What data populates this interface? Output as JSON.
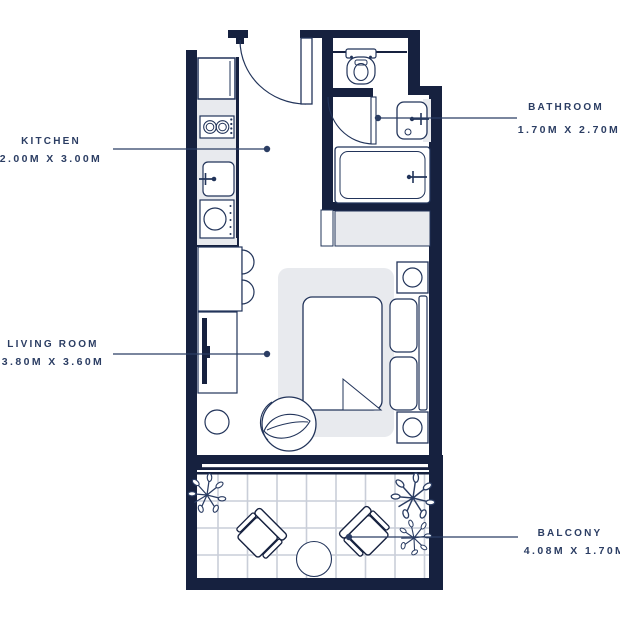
{
  "plan": {
    "type": "floorplan",
    "rooms": [
      {
        "id": "kitchen",
        "label": "KITCHEN",
        "dims": "2.00M X 3.00M"
      },
      {
        "id": "bathroom",
        "label": "BATHROOM",
        "dims": "1.70M X 2.70M"
      },
      {
        "id": "living-room",
        "label": "LIVING ROOM",
        "dims": "3.80M X 3.60M"
      },
      {
        "id": "balcony",
        "label": "BALCONY",
        "dims": "4.08M X 1.70M"
      }
    ],
    "colors": {
      "wall": "#16213f",
      "outline": "#22345a",
      "label_text": "#2b3d63",
      "light_fill": "#e8eaee",
      "tile_grid": "#c9ced8",
      "background": "#ffffff"
    },
    "fixtures": [
      "fridge",
      "stove",
      "sink",
      "washing-machine",
      "breakfast-counter",
      "tv-console",
      "tv",
      "stool",
      "armchair",
      "rug",
      "bed",
      "pillow",
      "nightstand",
      "wardrobe",
      "bathtub",
      "washbasin",
      "toilet",
      "entry-door",
      "bathroom-door",
      "balcony-table",
      "balcony-chair",
      "plant"
    ]
  }
}
